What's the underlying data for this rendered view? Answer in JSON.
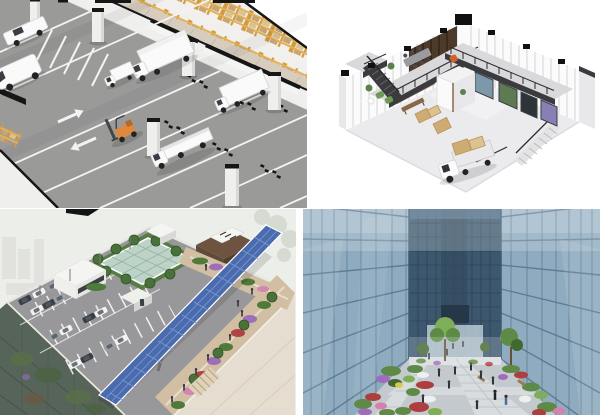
{
  "collage": {
    "label": "Collage of four architectural 3D renderings in a 2 by 2 grid",
    "panels": [
      {
        "id": "warehouse",
        "label": "Indoor logistics street with loading docks, white trucks, orange forklift and pallet racking filled with cardboard boxes"
      },
      {
        "id": "office",
        "label": "Isometric cutaway of a double-height office showroom with L-shaped mezzanine, two staircases, wooden furniture and a docked delivery truck"
      },
      {
        "id": "rooftop",
        "label": "Aerial view of a rooftop parking deck with cars, central skylight garden, long blue solar panel canopy and flower promenade"
      },
      {
        "id": "courtyard",
        "label": "Landscaped courtyard garden with colorful flower beds and pedestrians between two glass office towers"
      }
    ]
  },
  "palette": {
    "wh_road": "#9a9a99",
    "wh_mark": "#f2f3f2",
    "wh_wall": "#efefee",
    "wh_wallShade": "#d9d9d8",
    "wh_black": "#161616",
    "wh_rack": "#d39a3f",
    "wh_rackLight": "#e3b055",
    "wh_box": "#c8a671",
    "wh_boxLight": "#dcc28e",
    "wh_walk": "#d6cdbf",
    "wh_walkLine": "#c3b9a9",
    "wh_vehicle": "#fafafa",
    "wh_vehicleShade": "#d5d6d8",
    "wh_glass": "#3a3e44",
    "wh_forklift": "#dd8a3e",
    "wh_floor": "#f1f0ed",
    "of_floor": "#ebebed",
    "of_floorLight": "#f3f3f5",
    "of_steel": "#3b3b3f",
    "of_rail": "#2b2b2e",
    "of_mullion": "#c7cbcd",
    "of_wood": "#8a6746",
    "of_woodDark": "#4e3a2b",
    "of_gray": "#9a9b9e",
    "of_orange": "#d2622a",
    "of_green": "#6f9a54",
    "of_plant": "#5d7f4b",
    "of_box": "#cdab72",
    "of_glassBlue": "#7d98ab",
    "of_glassGreen": "#5d7a50",
    "of_glassDark": "#2e3338",
    "of_glassPurple": "#8a7fb5",
    "of_shade": "#dcdcde",
    "of_wall": "#fbfbfc",
    "rf_bg": "#eceeea",
    "rf_deck": "#98989b",
    "rf_line": "#ffffff",
    "rf_path": "#d2bfa3",
    "rf_pathLight": "#e0d2b8",
    "rf_green": "#4e7a3a",
    "rf_tree": "#4a7238",
    "rf_skylight": "#bdd3c7",
    "rf_skyLine": "#93b2a5",
    "rf_brown": "#6d5340",
    "rf_brownDark": "#533f2e",
    "rf_sign": "#f5f5f2",
    "rf_panel": "#4a6cae",
    "rf_panelLine": "#7e9ad0",
    "rf_white": "#f4f4f2",
    "rf_carDark": "#3a3f46",
    "rf_carGray": "#9aa0a6",
    "rf_carWhite": "#f2f2f2",
    "rf_facade": "#56645a",
    "rf_facadeLine": "#46534a",
    "rf_beige": "#e5ddd0",
    "rf_flowerPurple": "#9d6fba",
    "rf_flowerRed": "#b04444",
    "rf_flowerPink": "#d585b0",
    "rf_people": "#33373c",
    "rf_black": "#141414",
    "ct_glass": "#8fabbf",
    "ct_glassLight": "#b6c9d6",
    "ct_frame": "#55748c",
    "ct_far": "#3d586e",
    "ct_farDark": "#2c4257",
    "ct_glow": "#b9c9d2",
    "ct_path": "#ced3d6",
    "ct_pathLight": "#d8dcde",
    "ct_pathShade": "#b9bfc3",
    "ct_green": "#5d8a46",
    "ct_greenDark": "#42672f",
    "ct_greenLight": "#7fae58",
    "ct_purple": "#a06cc0",
    "ct_red": "#ad3f3f",
    "ct_pink": "#d77fae",
    "ct_white": "#edf0f0",
    "ct_yellow": "#d8c84e",
    "ct_people": "#2e3338",
    "ct_wood": "#9a7a52",
    "ct_trunk": "#6b4f35"
  }
}
